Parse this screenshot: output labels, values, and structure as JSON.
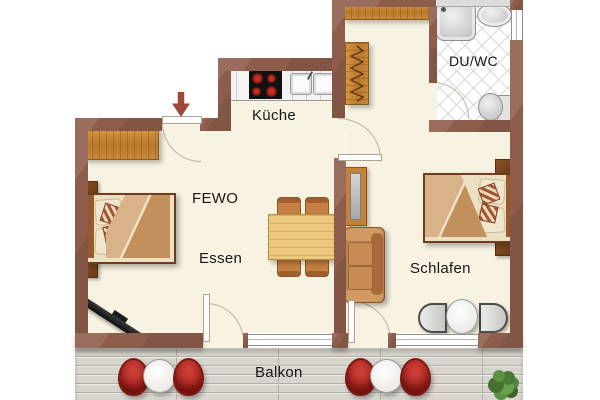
{
  "rooms": {
    "kitchen": {
      "label": "Küche"
    },
    "bath": {
      "label": "DU/WC"
    },
    "apartment": {
      "label": "FEWO"
    },
    "dining": {
      "label": "Essen"
    },
    "bedroom": {
      "label": "Schlafen"
    },
    "balcony": {
      "label": "Balkon"
    }
  },
  "colors": {
    "wall": "#8e5c4b",
    "floor": "#f7f2e1",
    "wood": "#c9883a",
    "deck": "#d8d4ce",
    "accent_red": "#a52420",
    "text": "#171717"
  },
  "icons": {
    "entry_arrow": "down-arrow"
  }
}
